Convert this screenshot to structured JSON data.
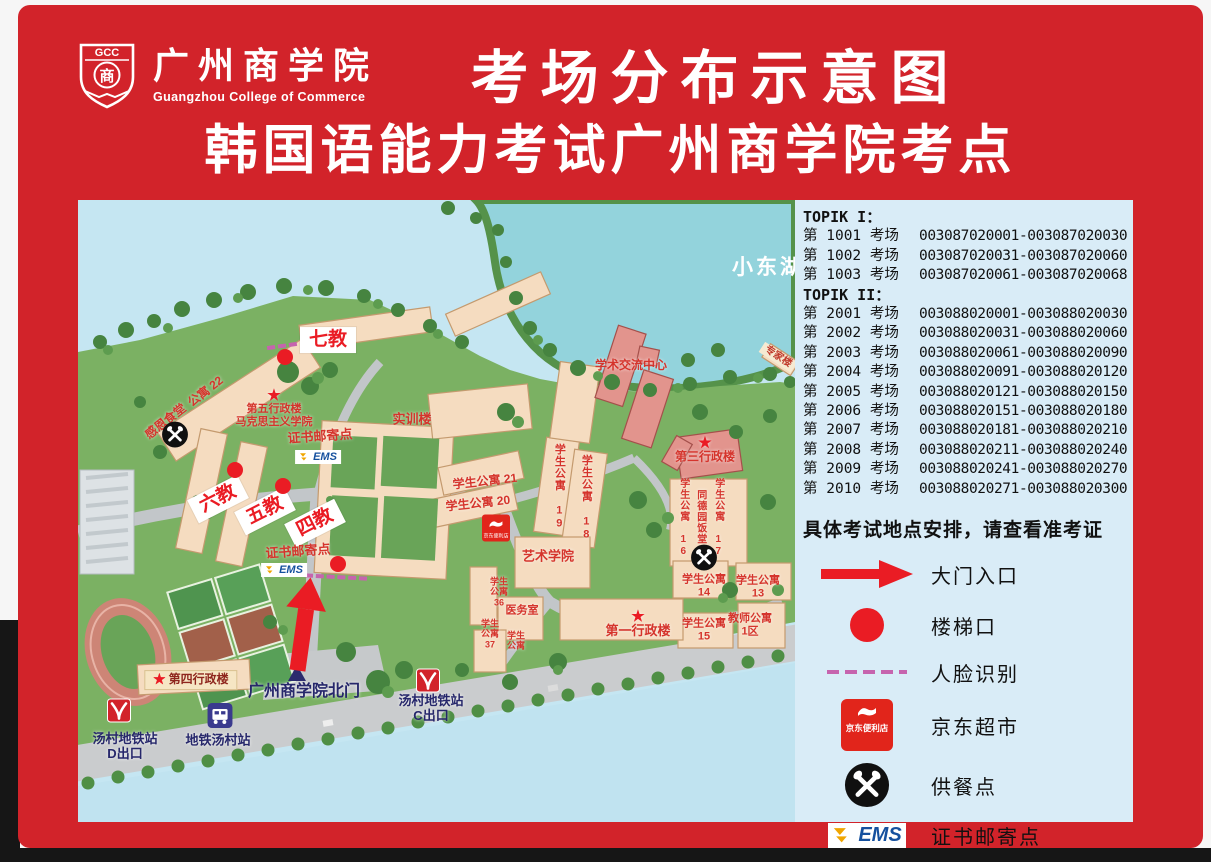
{
  "poster": {
    "logo": {
      "abbr": "GCC",
      "name_cn": "广州商学院",
      "name_en": "Guangzhou College of Commerce",
      "seal_char": "商"
    },
    "title_line1": "考场分布示意图",
    "title_line2": "韩国语能力考试广州商学院考点"
  },
  "room_assignments": {
    "sections": [
      {
        "header": "TOPIK I：",
        "rows": [
          {
            "room": "第 1001 考场",
            "tickets": "003087020001-003087020030"
          },
          {
            "room": "第 1002 考场",
            "tickets": "003087020031-003087020060"
          },
          {
            "room": "第 1003 考场",
            "tickets": "003087020061-003087020068"
          }
        ]
      },
      {
        "header": "TOPIK II：",
        "rows": [
          {
            "room": "第 2001 考场",
            "tickets": "003088020001-003088020030"
          },
          {
            "room": "第 2002 考场",
            "tickets": "003088020031-003088020060"
          },
          {
            "room": "第 2003 考场",
            "tickets": "003088020061-003088020090"
          },
          {
            "room": "第 2004 考场",
            "tickets": "003088020091-003088020120"
          },
          {
            "room": "第 2005 考场",
            "tickets": "003088020121-003088020150"
          },
          {
            "room": "第 2006 考场",
            "tickets": "003088020151-003088020180"
          },
          {
            "room": "第 2007 考场",
            "tickets": "003088020181-003088020210"
          },
          {
            "room": "第 2008 考场",
            "tickets": "003088020211-003088020240"
          },
          {
            "room": "第 2009 考场",
            "tickets": "003088020241-003088020270"
          },
          {
            "room": "第 2010 考场",
            "tickets": "003088020271-003088020300"
          }
        ]
      }
    ]
  },
  "note": "具体考试地点安排，请查看准考证",
  "legend": [
    {
      "icon": "arrow",
      "label": "大门入口"
    },
    {
      "icon": "dot",
      "label": "楼梯口"
    },
    {
      "icon": "dash",
      "label": "人脸识别"
    },
    {
      "icon": "jd",
      "label": "京东超市",
      "icon_text": "京东便利店"
    },
    {
      "icon": "meal",
      "label": "供餐点"
    },
    {
      "icon": "ems",
      "label": "证书邮寄点",
      "icon_text": "EMS"
    }
  ],
  "colors": {
    "poster_red": "#d2232a",
    "panel_blue": "#d9ecf7",
    "marker_red": "#ea1c24",
    "face_id_pink": "#c664ae",
    "ems_blue": "#15509e",
    "jd_red": "#e1251b",
    "navy": "#26276b"
  },
  "map": {
    "star_glyph": "★",
    "ems_text": "EMS",
    "jd_text": "京东便利店",
    "labels": [
      {
        "id": "qijiao",
        "type": "badge",
        "text": "七教",
        "x": 250,
        "y": 140,
        "fs": 19
      },
      {
        "id": "liujiao",
        "type": "badge",
        "text": "六教",
        "x": 140,
        "y": 299,
        "fs": 19,
        "rot": -27
      },
      {
        "id": "wujiao",
        "type": "badge",
        "text": "五教",
        "x": 187,
        "y": 311,
        "fs": 19,
        "rot": -27
      },
      {
        "id": "sijiao",
        "type": "badge",
        "text": "四教",
        "x": 237,
        "y": 323,
        "fs": 19,
        "rot": -27
      },
      {
        "id": "diwu-xingzhenglou",
        "type": "star-text",
        "star": true,
        "lines": [
          "第五行政楼",
          "马克思主义学院"
        ],
        "x": 196,
        "y": 208,
        "fs": 11
      },
      {
        "id": "zhengshu-youjidian-top",
        "type": "red",
        "text": "证书邮寄点",
        "x": 242,
        "y": 237,
        "fs": 13,
        "rot": -4
      },
      {
        "id": "shixunlou",
        "type": "red",
        "text": "实训楼",
        "x": 334,
        "y": 220,
        "fs": 13
      },
      {
        "id": "zhengshu-youjidian-bottom",
        "type": "red",
        "text": "证书邮寄点",
        "x": 220,
        "y": 352,
        "fs": 13,
        "rot": -4
      },
      {
        "id": "gongyu-22",
        "type": "red",
        "text": "公寓 22",
        "x": 128,
        "y": 192,
        "fs": 12,
        "rot": -38
      },
      {
        "id": "ganen-shitang",
        "type": "red",
        "text": "感恩食堂",
        "x": 88,
        "y": 222,
        "fs": 12,
        "rot": -38
      },
      {
        "id": "xuesheng-gongyu-21",
        "type": "red",
        "text": "学生公寓 21",
        "x": 407,
        "y": 282,
        "fs": 12,
        "rot": -6
      },
      {
        "id": "xuesheng-gongyu-20",
        "type": "red",
        "text": "学生公寓 20",
        "x": 400,
        "y": 304,
        "fs": 12,
        "rot": -6
      },
      {
        "id": "xuesheng-gongyu-19",
        "type": "red-vert",
        "text": "学生公寓 19",
        "x": 481,
        "y": 287,
        "fs": 11
      },
      {
        "id": "xuesheng-gongyu-18",
        "type": "red-vert",
        "text": "学生公寓 18",
        "x": 508,
        "y": 298,
        "fs": 11
      },
      {
        "id": "yishu-xueyuan",
        "type": "red",
        "text": "艺术学院",
        "x": 470,
        "y": 357,
        "fs": 13
      },
      {
        "id": "xueshu-jiaoliu-zhongxin",
        "type": "red",
        "text": "学术交流中心",
        "x": 553,
        "y": 166,
        "fs": 12
      },
      {
        "id": "disan-xingzhenglou",
        "type": "star-text",
        "star": true,
        "lines": [
          "第三行政楼"
        ],
        "x": 627,
        "y": 250,
        "fs": 12
      },
      {
        "id": "xuesheng-gongyu-16",
        "type": "red-vert",
        "text": "学生公寓 16",
        "x": 605,
        "y": 318,
        "fs": 10
      },
      {
        "id": "tongdeyuan-fantang",
        "type": "red-vert",
        "text": "同德园饭堂",
        "x": 622,
        "y": 317,
        "fs": 10
      },
      {
        "id": "xuesheng-gongyu-17",
        "type": "red-vert",
        "text": "学生公寓 17",
        "x": 640,
        "y": 318,
        "fs": 10
      },
      {
        "id": "xuesheng-gongyu-14",
        "type": "red-lines",
        "lines": [
          "学生公寓",
          "14"
        ],
        "x": 626,
        "y": 386,
        "fs": 11
      },
      {
        "id": "xuesheng-gongyu-13",
        "type": "red-lines",
        "lines": [
          "学生公寓",
          "13"
        ],
        "x": 680,
        "y": 387,
        "fs": 11
      },
      {
        "id": "xuesheng-gongyu-15",
        "type": "red-lines",
        "lines": [
          "学生公寓",
          "15"
        ],
        "x": 626,
        "y": 430,
        "fs": 11
      },
      {
        "id": "jiaoshi-gongyu-1qu",
        "type": "red-lines",
        "lines": [
          "教师公寓",
          "1区"
        ],
        "x": 672,
        "y": 425,
        "fs": 11
      },
      {
        "id": "yiwushi",
        "type": "red",
        "text": "医务室",
        "x": 444,
        "y": 411,
        "fs": 11
      },
      {
        "id": "xuesheng-gongyu-36",
        "type": "red-lines",
        "lines": [
          "学生",
          "公寓",
          "36"
        ],
        "x": 421,
        "y": 392,
        "fs": 9
      },
      {
        "id": "xuesheng-gongyu-37",
        "type": "red-lines",
        "lines": [
          "学生",
          "公寓",
          "37"
        ],
        "x": 412,
        "y": 434,
        "fs": 9
      },
      {
        "id": "xuesheng-gongyu-extra",
        "type": "red-lines",
        "lines": [
          "学生",
          "公寓"
        ],
        "x": 438,
        "y": 441,
        "fs": 9
      },
      {
        "id": "diyi-xingzhenglou",
        "type": "star-text",
        "star": true,
        "lines": [
          "第一行政楼"
        ],
        "x": 560,
        "y": 424,
        "fs": 13
      },
      {
        "id": "xiaodonghu",
        "type": "white-lake",
        "text": "小东湖",
        "x": 690,
        "y": 68,
        "fs": 21
      },
      {
        "id": "zhuanjialou",
        "type": "sign",
        "text": "专家楼",
        "x": 700,
        "y": 157,
        "fs": 10,
        "rot": 33
      },
      {
        "id": "beimen",
        "type": "navy",
        "text": "广州商学院北门",
        "x": 226,
        "y": 492,
        "fs": 16
      },
      {
        "id": "disi-xingzhenglou",
        "type": "plaque",
        "text": "第四行政楼",
        "x": 113,
        "y": 480,
        "fs": 12
      },
      {
        "id": "tangcun-ditiezhan-d",
        "type": "navy-lines",
        "lines": [
          "汤村地铁站",
          "D出口"
        ],
        "x": 47,
        "y": 547,
        "fs": 13
      },
      {
        "id": "ditie-tangcunzhan",
        "type": "navy",
        "text": "地铁汤村站",
        "x": 140,
        "y": 541,
        "fs": 13
      },
      {
        "id": "tangcun-ditiezhan-c",
        "type": "navy-lines",
        "lines": [
          "汤村地铁站",
          "C出口"
        ],
        "x": 353,
        "y": 509,
        "fs": 13
      }
    ],
    "markers": [
      {
        "type": "dot",
        "x": 207,
        "y": 157
      },
      {
        "type": "dot",
        "x": 157,
        "y": 270
      },
      {
        "type": "dot",
        "x": 205,
        "y": 286
      },
      {
        "type": "dot",
        "x": 260,
        "y": 364
      },
      {
        "type": "dash",
        "x": 204,
        "y": 146,
        "w": 30,
        "rot": -8
      },
      {
        "type": "dash",
        "x": 258,
        "y": 377,
        "w": 62,
        "rot": 3
      },
      {
        "type": "meal",
        "x": 97,
        "y": 237
      },
      {
        "type": "meal",
        "x": 626,
        "y": 360
      },
      {
        "type": "ems",
        "x": 240,
        "y": 257
      },
      {
        "type": "ems",
        "x": 206,
        "y": 370
      },
      {
        "type": "jd",
        "x": 418,
        "y": 328
      },
      {
        "type": "metro",
        "x": 41,
        "y": 513
      },
      {
        "type": "metro",
        "x": 350,
        "y": 483
      },
      {
        "type": "bus",
        "x": 142,
        "y": 518
      },
      {
        "type": "gate",
        "x": 219,
        "y": 473
      },
      {
        "type": "up-arrow",
        "x": 226,
        "y": 424,
        "rot": 8
      }
    ]
  }
}
